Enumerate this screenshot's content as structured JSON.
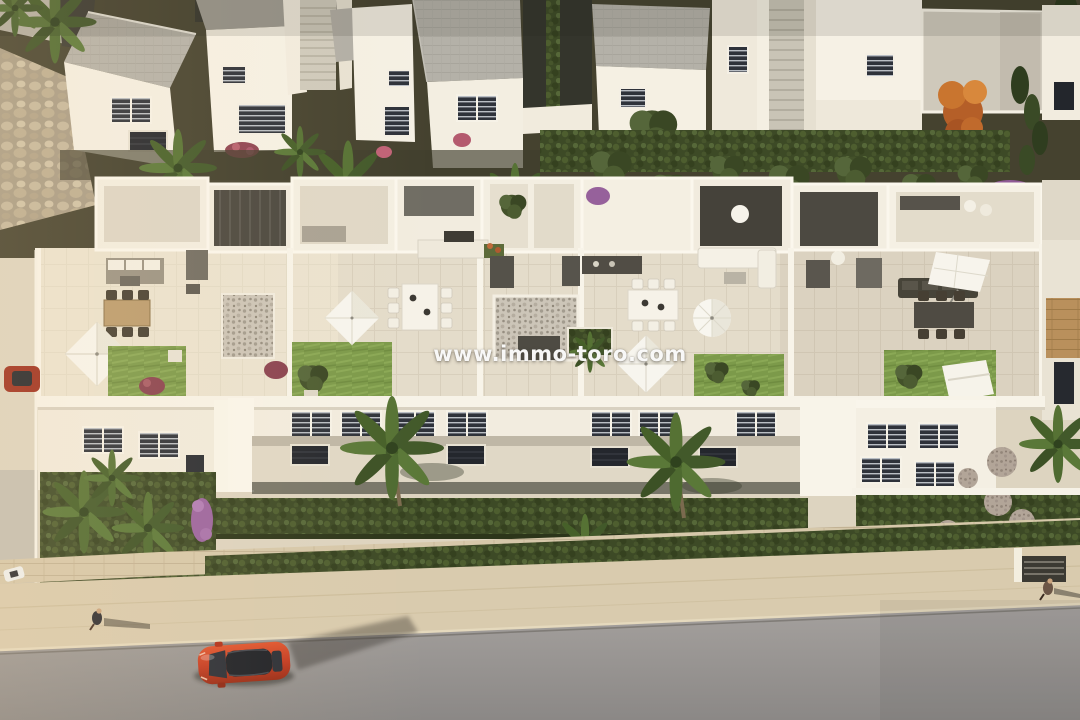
{
  "image": {
    "type": "architectural-aerial-render",
    "subject": "New-build white townhouses with rooftop terraces, gardens and street, seen from above in warm evening light"
  },
  "watermark": {
    "text": "www.immo-toro.com",
    "color": "#ffffff"
  },
  "palette": {
    "wall_white_sunlit": "#f8f4ea",
    "wall_white_shaded": "#ddd6c6",
    "roof_grey": "#b5b2a9",
    "terrace_tile": "#e6dfcd",
    "lawn_green": "#7a9747",
    "hedge_green": "#3f4c28",
    "road_grey": "#9a9694",
    "stone_beige": "#d6c8aa",
    "car_red": "#c43c22",
    "autumn_tree_orange": "#c06a2e",
    "bougainvillea_purple": "#96619b"
  },
  "objects": [
    "back-row-houses",
    "rooftop-terraces",
    "square-parasols",
    "round-parasol",
    "outdoor-dining-sets",
    "lounge-sofas",
    "roof-lawns",
    "front-facades",
    "front-hedges",
    "palm-trees",
    "retaining-wall",
    "street",
    "red-car",
    "parked-red-car",
    "pedestrians"
  ]
}
